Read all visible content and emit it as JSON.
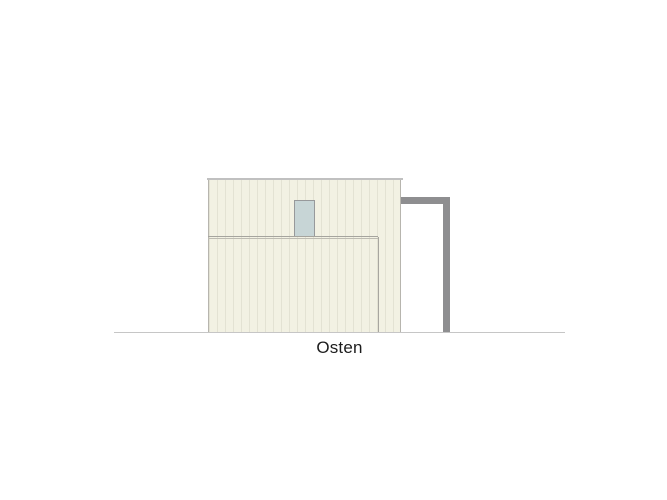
{
  "drawing": {
    "label": "Osten"
  },
  "colors": {
    "background": "#ffffff",
    "facade_fill": "#f2f1e3",
    "facade_stripe": "#e3e2d3",
    "facade_edge": "#b7b5ae",
    "roof_edge": "#c0c0c0",
    "window_fill": "#c7d5d6",
    "window_border": "#97999b",
    "divider_line_dark": "#a5a49e",
    "divider_line_light": "#bdbbb2",
    "lower_wall_line": "#a8a6a0",
    "frame_gray": "#8e8e90",
    "ground_line": "#c6c6c6",
    "label_text": "#1c1c1c"
  }
}
